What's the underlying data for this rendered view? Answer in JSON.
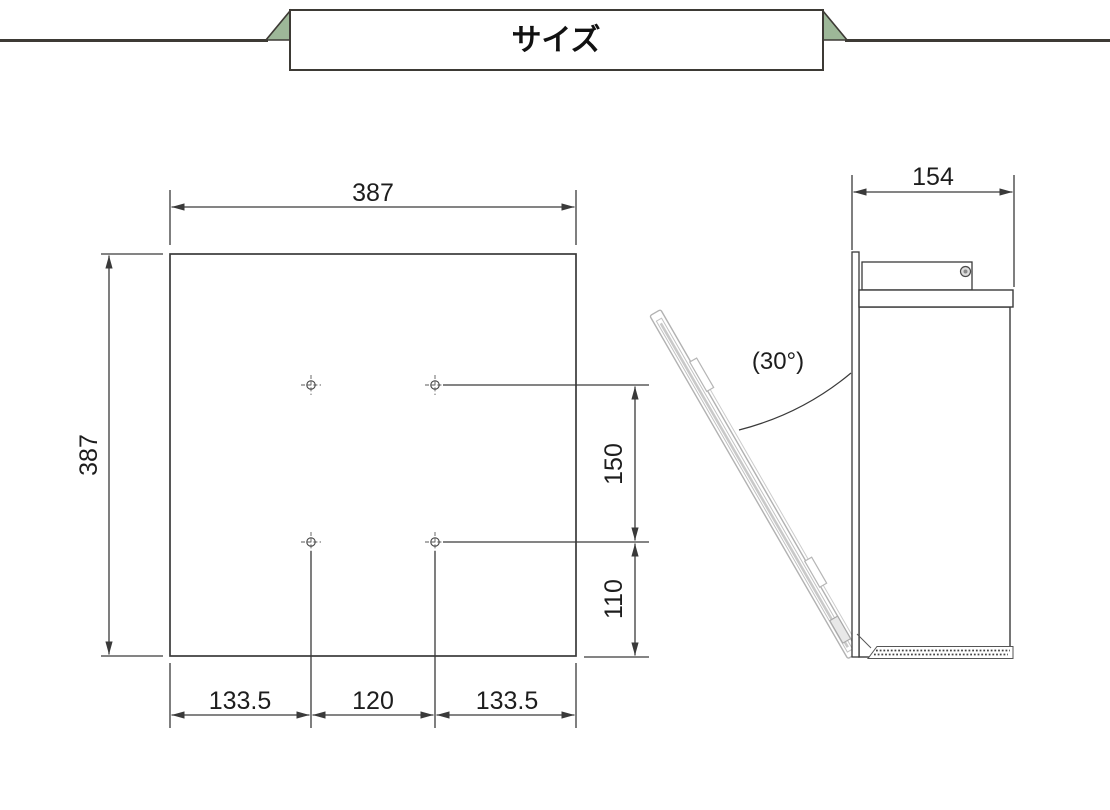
{
  "header": {
    "title": "サイズ",
    "accent_color": "#9db798",
    "line_color": "#3d3a35"
  },
  "front_view": {
    "dims": {
      "width": "387",
      "height": "387",
      "hole_vertical_spacing": "150",
      "hole_bottom_offset": "110",
      "bottom_left": "133.5",
      "bottom_center": "120",
      "bottom_right": "133.5"
    }
  },
  "side_view": {
    "dims": {
      "depth": "154",
      "open_angle": "(30°)"
    },
    "door_color": "#b5b5b5"
  },
  "icons": {
    "screw_icon": "concentric-circles",
    "hole_marker_icon": "circle-crosshair"
  },
  "drawing_line_color": "#3a3a3a"
}
